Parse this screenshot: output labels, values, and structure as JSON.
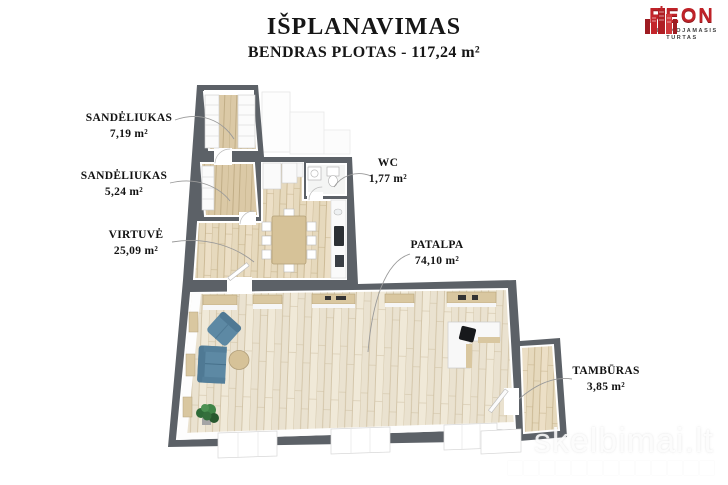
{
  "header": {
    "title": "IŠPLANAVIMAS",
    "subtitle": "BENDRAS PLOTAS - 117,24 m²"
  },
  "logo": {
    "name": "REON",
    "tagline_line1": "NEKILNOJAMASIS",
    "tagline_line2": "TURTAS",
    "brand_color": "#bf2228"
  },
  "rooms": [
    {
      "name": "SANDĖLIUKAS",
      "area": "7,19 m²"
    },
    {
      "name": "SANDĖLIUKAS",
      "area": "5,24 m²"
    },
    {
      "name": "VIRTUVĖ",
      "area": "25,09 m²"
    },
    {
      "name": "WC",
      "area": "1,77 m²"
    },
    {
      "name": "PATALPA",
      "area": "74,10 m²"
    },
    {
      "name": "TAMBŪRAS",
      "area": "3,85 m²"
    }
  ],
  "watermark": {
    "text": "skelbimai.lt"
  },
  "colors": {
    "wall_gray": "#5c6167",
    "floor_wood": "#e9e1cd",
    "sofa_blue": "#5d89a4",
    "brand_red": "#bf2228"
  }
}
